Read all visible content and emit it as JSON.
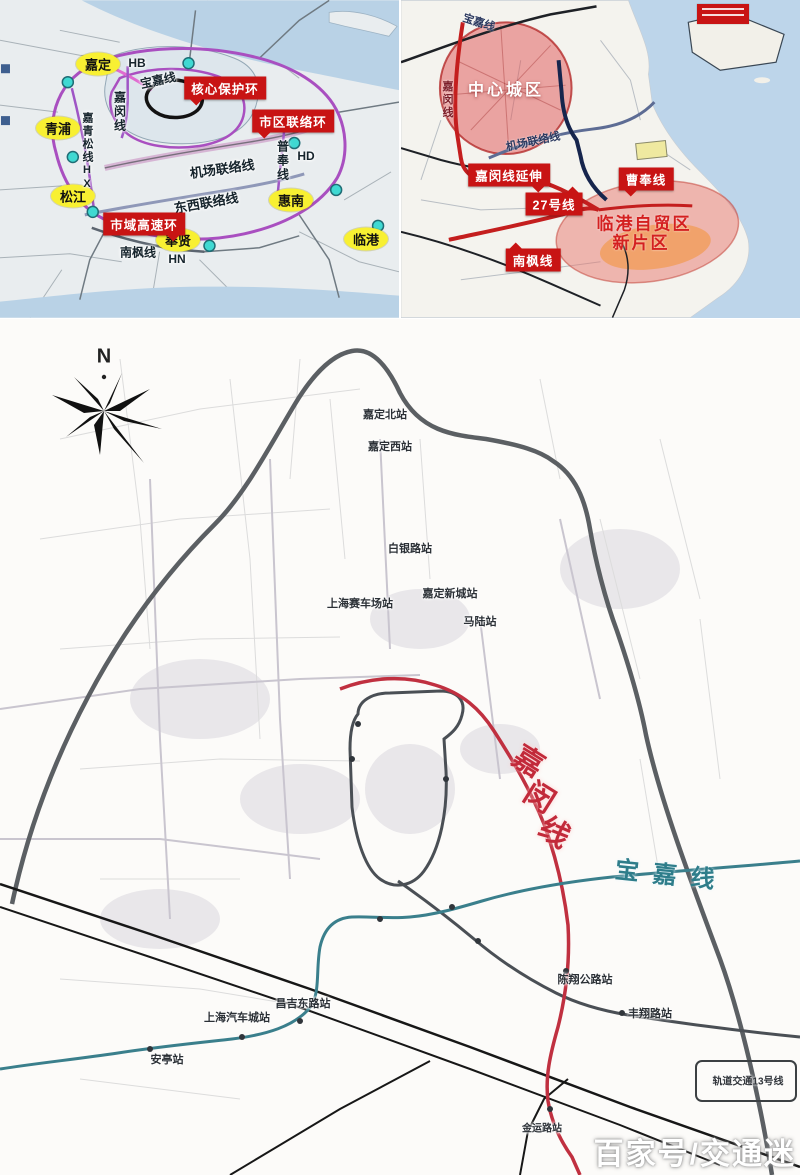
{
  "watermark": "百家号/交通迷",
  "colors": {
    "banner_red": "#c81414",
    "badge_yellow": "#f8f032",
    "ring_purple": "#a94fc0",
    "jiamin_red": "#c22a3a",
    "baojia_teal": "#2e7d8a",
    "sea_blue": "#bdd5ea"
  },
  "panel_top_left": {
    "badges": [
      "嘉定",
      "青浦",
      "松江",
      "奉贤",
      "惠南",
      "临港"
    ],
    "banners": [
      "核心保护环",
      "市区联络环",
      "市域高速环"
    ],
    "lines": {
      "hb": "HB",
      "baojia": "宝嘉线",
      "jiamin": "嘉闵线",
      "jiaqingsong": "嘉青松线HX",
      "jichang": "机场联络线",
      "pufeng": "普奉线",
      "hd": "HD",
      "dongxi": "东西联络线",
      "nanfeng": "南枫线",
      "hn": "HN"
    }
  },
  "panel_top_right": {
    "areas": {
      "central": "中心城区",
      "lingang_line1": "临港自贸区",
      "lingang_line2": "新片区"
    },
    "banners": {
      "jiamin_ext": "嘉闵线延伸",
      "line27": "27号线",
      "caofeng": "曹奉线",
      "nanfeng": "南枫线"
    },
    "lines": {
      "baojia": "宝嘉线",
      "jiamin": "嘉闵线",
      "jichang": "机场联络线"
    }
  },
  "panel_main": {
    "compass_label": "N",
    "lines": {
      "jiamin_chars": [
        "嘉",
        "闵",
        "线"
      ],
      "baojia": "宝嘉线"
    },
    "stations": {
      "jiadingbei": "嘉定北站",
      "jiadingxi": "嘉定西站",
      "baiyinlu": "白银路站",
      "saichechang": "上海赛车场站",
      "jiadingxincheng": "嘉定新城站",
      "malu": "马陆站",
      "qichecheng": "上海汽车城站",
      "changji": "昌吉东路站",
      "anting": "安亭站",
      "chenxiang": "陈翔公路站",
      "fengxiang": "丰翔路站",
      "jinyunlu": "金运路站"
    },
    "rail_note": "轨道交通13号线"
  }
}
